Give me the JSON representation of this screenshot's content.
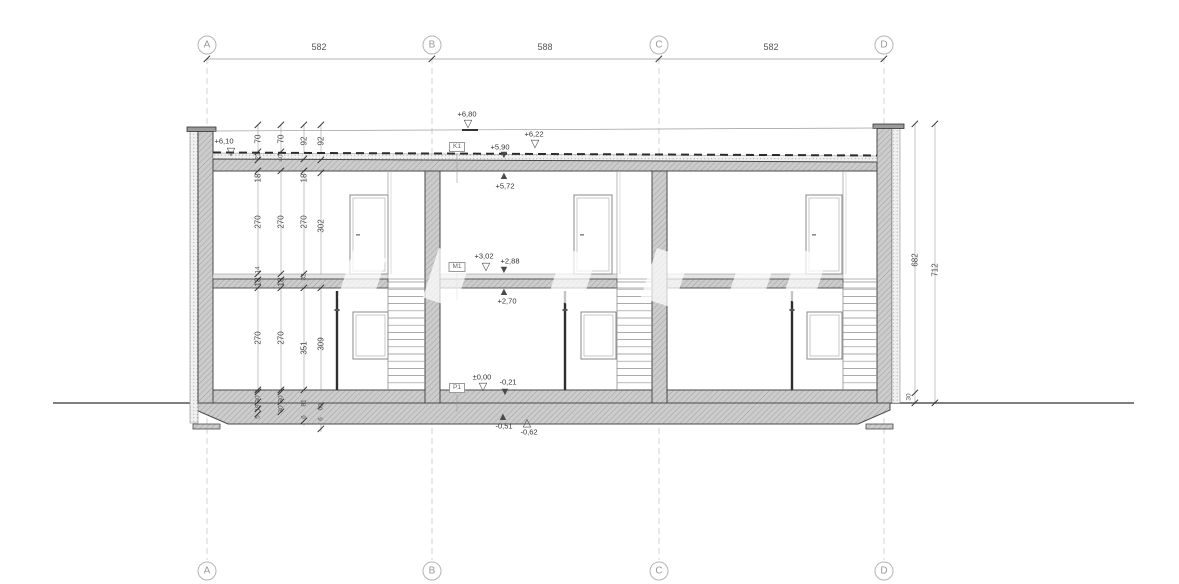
{
  "drawing": {
    "grid": {
      "column_labels": [
        "A",
        "B",
        "C",
        "D"
      ],
      "column_x": [
        207,
        432,
        659,
        884
      ],
      "top_circle_y": 45,
      "bottom_circle_y": 571,
      "top_spans": [
        {
          "label": "582",
          "x": 319
        },
        {
          "label": "588",
          "x": 545
        },
        {
          "label": "582",
          "x": 771
        }
      ]
    },
    "dimension_labels": [
      {
        "t": "70",
        "x": 258,
        "y": 139
      },
      {
        "t": "22",
        "x": 258,
        "y": 156,
        "s": 1
      },
      {
        "t": "18",
        "x": 258,
        "y": 178
      },
      {
        "t": "270",
        "x": 258,
        "y": 222
      },
      {
        "t": "14",
        "x": 258,
        "y": 270,
        "s": 1
      },
      {
        "t": "18",
        "x": 258,
        "y": 282
      },
      {
        "t": "270",
        "x": 258,
        "y": 338
      },
      {
        "t": "2",
        "x": 258,
        "y": 391,
        "s": 1
      },
      {
        "t": "30",
        "x": 258,
        "y": 399,
        "s": 1
      },
      {
        "t": "19",
        "x": 258,
        "y": 408,
        "s": 1
      },
      {
        "t": "5",
        "x": 258,
        "y": 417,
        "s": 1
      },
      {
        "t": "70",
        "x": 281,
        "y": 139
      },
      {
        "t": "40",
        "x": 281,
        "y": 158,
        "s": 1
      },
      {
        "t": "270",
        "x": 281,
        "y": 222
      },
      {
        "t": "18",
        "x": 281,
        "y": 282
      },
      {
        "t": "270",
        "x": 281,
        "y": 338
      },
      {
        "t": "30",
        "x": 281,
        "y": 399,
        "s": 1
      },
      {
        "t": "30",
        "x": 281,
        "y": 409,
        "s": 1
      },
      {
        "t": "92",
        "x": 304,
        "y": 141
      },
      {
        "t": "18",
        "x": 304,
        "y": 178
      },
      {
        "t": "270",
        "x": 304,
        "y": 222
      },
      {
        "t": "32",
        "x": 304,
        "y": 277,
        "s": 1
      },
      {
        "t": "351",
        "x": 304,
        "y": 348
      },
      {
        "t": "81",
        "x": 304,
        "y": 403,
        "s": 1
      },
      {
        "t": "6",
        "x": 304,
        "y": 417,
        "s": 1
      },
      {
        "t": "92",
        "x": 321,
        "y": 141
      },
      {
        "t": "302",
        "x": 321,
        "y": 226
      },
      {
        "t": "309",
        "x": 321,
        "y": 344
      },
      {
        "t": "60",
        "x": 321,
        "y": 407,
        "s": 1
      },
      {
        "t": "6",
        "x": 321,
        "y": 419,
        "s": 1
      },
      {
        "t": "682",
        "x": 915,
        "y": 260
      },
      {
        "t": "30",
        "x": 909,
        "y": 397,
        "s": 1
      },
      {
        "t": "712",
        "x": 935,
        "y": 270
      }
    ],
    "ticks": [
      [
        207,
        59
      ],
      [
        432,
        59
      ],
      [
        659,
        59
      ],
      [
        884,
        59
      ],
      [
        258,
        125
      ],
      [
        258,
        152
      ],
      [
        258,
        160
      ],
      [
        258,
        171
      ],
      [
        258,
        274
      ],
      [
        258,
        280
      ],
      [
        258,
        288
      ],
      [
        258,
        390
      ],
      [
        258,
        392
      ],
      [
        258,
        402
      ],
      [
        258,
        409
      ],
      [
        258,
        414
      ],
      [
        281,
        125
      ],
      [
        281,
        152
      ],
      [
        281,
        171
      ],
      [
        281,
        274
      ],
      [
        281,
        280
      ],
      [
        281,
        288
      ],
      [
        281,
        390
      ],
      [
        281,
        392
      ],
      [
        281,
        402
      ],
      [
        281,
        412
      ],
      [
        304,
        125
      ],
      [
        304,
        159
      ],
      [
        304,
        171
      ],
      [
        304,
        274
      ],
      [
        304,
        288
      ],
      [
        304,
        390
      ],
      [
        304,
        421
      ],
      [
        321,
        125
      ],
      [
        321,
        160
      ],
      [
        321,
        173
      ],
      [
        321,
        288
      ],
      [
        321,
        406
      ],
      [
        321,
        429
      ],
      [
        915,
        124
      ],
      [
        915,
        393
      ],
      [
        915,
        403
      ],
      [
        935,
        124
      ],
      [
        935,
        403
      ]
    ],
    "elevation_markers": [
      {
        "t": "+6,10",
        "x": 224,
        "y": 141,
        "glyph": "▽",
        "gx": 231,
        "gy": 152
      },
      {
        "t": "+6,80",
        "x": 467,
        "y": 114,
        "glyph": "▽",
        "gx": 468,
        "gy": 124
      },
      {
        "t": "+6,22",
        "x": 534,
        "y": 134,
        "glyph": "▽",
        "gx": 535,
        "gy": 144
      },
      {
        "t": "+5,90",
        "x": 500,
        "y": 147,
        "glyph": "▼",
        "gx": 504,
        "gy": 155
      },
      {
        "t": "+5,72",
        "x": 505,
        "y": 186,
        "glyph": "▲",
        "gx": 504,
        "gy": 176
      },
      {
        "t": "+3,02",
        "x": 484,
        "y": 256,
        "glyph": "▽",
        "gx": 486,
        "gy": 267
      },
      {
        "t": "+2,88",
        "x": 510,
        "y": 261,
        "glyph": "▼",
        "gx": 504,
        "gy": 270
      },
      {
        "t": "+2,70",
        "x": 507,
        "y": 301,
        "glyph": "▲",
        "gx": 504,
        "gy": 292
      },
      {
        "t": "±0,00",
        "x": 482,
        "y": 377,
        "glyph": "▽",
        "gx": 483,
        "gy": 387
      },
      {
        "t": "-0,21",
        "x": 508,
        "y": 382,
        "glyph": "▼",
        "gx": 505,
        "gy": 392
      },
      {
        "t": "-0,51",
        "x": 504,
        "y": 426,
        "glyph": "▲",
        "gx": 503,
        "gy": 417
      },
      {
        "t": "-0,62",
        "x": 529,
        "y": 432,
        "glyph": "△",
        "gx": 527,
        "gy": 423
      }
    ],
    "reference_boxes": [
      {
        "label": "K1",
        "x": 457,
        "y": 147
      },
      {
        "label": "M1",
        "x": 457,
        "y": 267
      },
      {
        "label": "P1",
        "x": 457,
        "y": 388
      }
    ]
  }
}
